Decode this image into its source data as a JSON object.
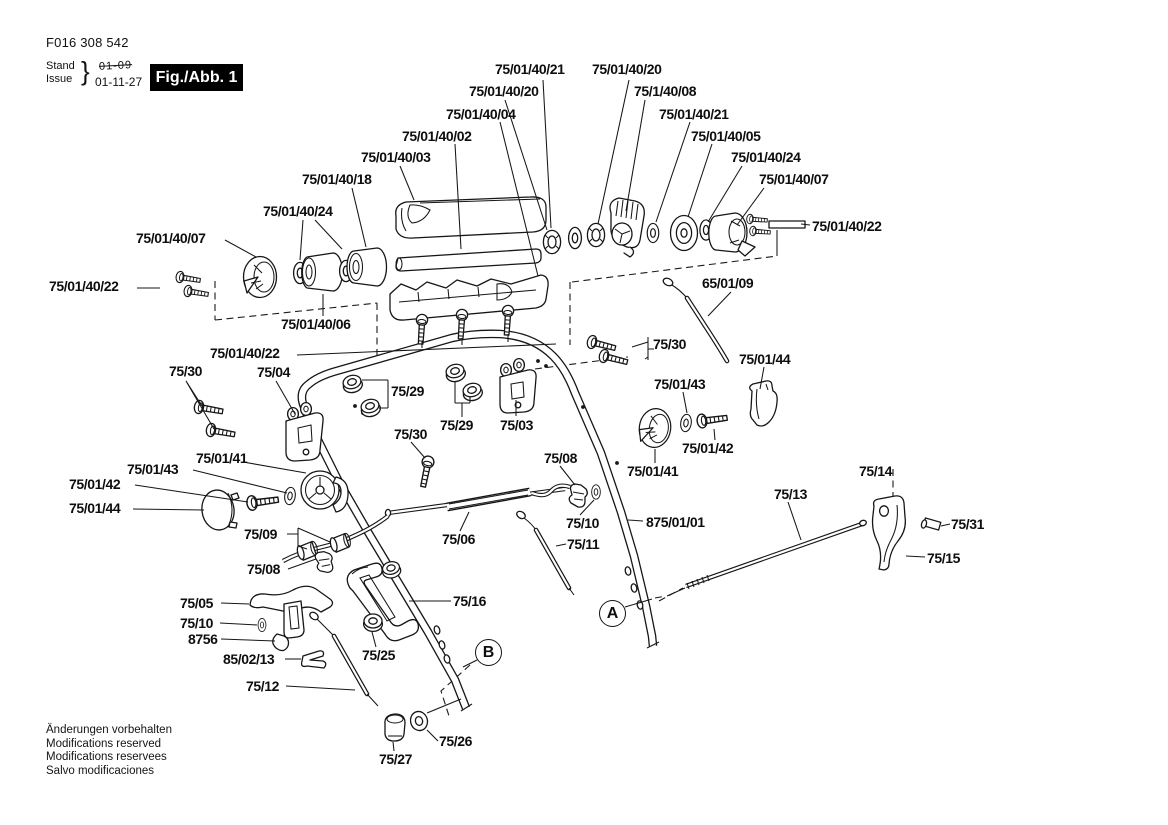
{
  "header": {
    "doc_number": "F016 308 542",
    "stand_label": "Stand",
    "issue_label": "Issue",
    "brace": "}",
    "old_date": "01-09",
    "date": "01-11-27",
    "figure_label": "Fig./Abb. 1"
  },
  "footer": {
    "line1": "Änderungen vorbehalten",
    "line2": "Modifications reserved",
    "line3": "Modifications reservees",
    "line4": "Salvo modificaciones"
  },
  "diagram": {
    "description": "Exploded spare-parts drawing of lawnmower handle assembly",
    "markers": [
      {
        "letter": "A",
        "x": 599,
        "y": 600
      },
      {
        "letter": "B",
        "x": 475,
        "y": 639
      }
    ],
    "callouts": [
      {
        "text": "75/01/40/21",
        "x": 495,
        "y": 62
      },
      {
        "text": "75/01/40/20",
        "x": 592,
        "y": 62
      },
      {
        "text": "75/01/40/20",
        "x": 469,
        "y": 84
      },
      {
        "text": "75/1/40/08",
        "x": 634,
        "y": 84
      },
      {
        "text": "75/01/40/04",
        "x": 446,
        "y": 107
      },
      {
        "text": "75/01/40/21",
        "x": 659,
        "y": 107
      },
      {
        "text": "75/01/40/02",
        "x": 402,
        "y": 129
      },
      {
        "text": "75/01/40/05",
        "x": 691,
        "y": 129
      },
      {
        "text": "75/01/40/03",
        "x": 361,
        "y": 150
      },
      {
        "text": "75/01/40/24",
        "x": 731,
        "y": 150
      },
      {
        "text": "75/01/40/18",
        "x": 302,
        "y": 172
      },
      {
        "text": "75/01/40/07",
        "x": 759,
        "y": 172
      },
      {
        "text": "75/01/40/24",
        "x": 263,
        "y": 204
      },
      {
        "text": "75/01/40/22",
        "x": 812,
        "y": 219
      },
      {
        "text": "75/01/40/07",
        "x": 136,
        "y": 231
      },
      {
        "text": "65/01/09",
        "x": 702,
        "y": 276
      },
      {
        "text": "75/01/40/22",
        "x": 49,
        "y": 279
      },
      {
        "text": "75/01/40/06",
        "x": 281,
        "y": 317
      },
      {
        "text": "75/30",
        "x": 653,
        "y": 337
      },
      {
        "text": "75/01/40/22",
        "x": 210,
        "y": 346
      },
      {
        "text": "75/01/44",
        "x": 739,
        "y": 352
      },
      {
        "text": "75/30",
        "x": 169,
        "y": 364
      },
      {
        "text": "75/04",
        "x": 257,
        "y": 365
      },
      {
        "text": "75/01/43",
        "x": 654,
        "y": 377
      },
      {
        "text": "75/29",
        "x": 391,
        "y": 384
      },
      {
        "text": "75/29",
        "x": 440,
        "y": 418
      },
      {
        "text": "75/03",
        "x": 500,
        "y": 418
      },
      {
        "text": "75/30",
        "x": 394,
        "y": 427
      },
      {
        "text": "75/01/42",
        "x": 682,
        "y": 441
      },
      {
        "text": "75/01/41",
        "x": 196,
        "y": 451
      },
      {
        "text": "75/08",
        "x": 544,
        "y": 451
      },
      {
        "text": "75/01/43",
        "x": 127,
        "y": 462
      },
      {
        "text": "75/01/41",
        "x": 627,
        "y": 464
      },
      {
        "text": "75/14",
        "x": 859,
        "y": 464
      },
      {
        "text": "75/01/42",
        "x": 69,
        "y": 477
      },
      {
        "text": "75/13",
        "x": 774,
        "y": 487
      },
      {
        "text": "75/01/44",
        "x": 69,
        "y": 501
      },
      {
        "text": "875/01/01",
        "x": 646,
        "y": 515
      },
      {
        "text": "75/10",
        "x": 566,
        "y": 516
      },
      {
        "text": "75/31",
        "x": 951,
        "y": 517
      },
      {
        "text": "75/09",
        "x": 244,
        "y": 527
      },
      {
        "text": "75/06",
        "x": 442,
        "y": 532
      },
      {
        "text": "75/11",
        "x": 567,
        "y": 537
      },
      {
        "text": "75/15",
        "x": 927,
        "y": 551
      },
      {
        "text": "75/08",
        "x": 247,
        "y": 562
      },
      {
        "text": "75/16",
        "x": 453,
        "y": 594
      },
      {
        "text": "75/05",
        "x": 180,
        "y": 596
      },
      {
        "text": "75/10",
        "x": 180,
        "y": 616
      },
      {
        "text": "8756",
        "x": 188,
        "y": 632
      },
      {
        "text": "85/02/13",
        "x": 223,
        "y": 652
      },
      {
        "text": "75/25",
        "x": 362,
        "y": 648
      },
      {
        "text": "75/12",
        "x": 246,
        "y": 679
      },
      {
        "text": "75/26",
        "x": 439,
        "y": 734
      },
      {
        "text": "75/27",
        "x": 379,
        "y": 752
      }
    ]
  }
}
